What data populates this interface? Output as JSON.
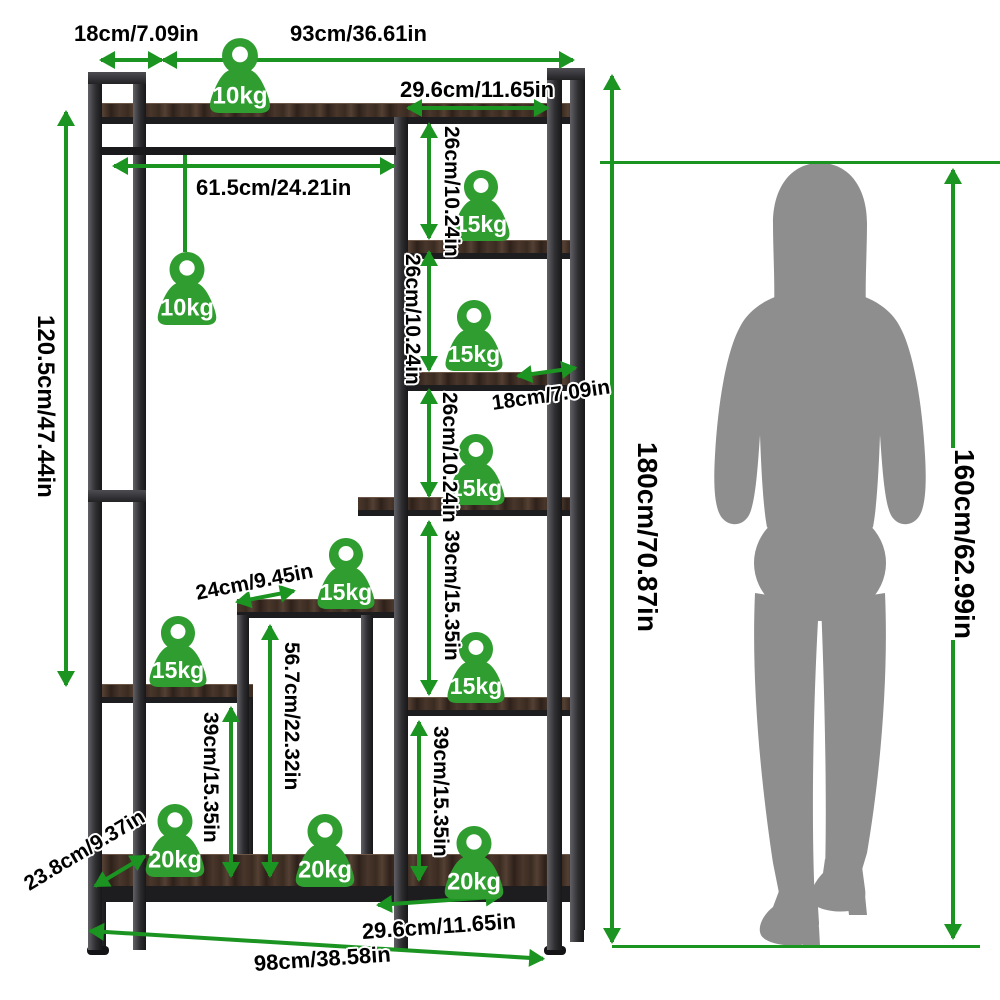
{
  "diagram": {
    "weights": {
      "top_shelf": "10kg",
      "hanging_rod": "10kg",
      "tower_shelf_1": "15kg",
      "tower_shelf_2": "15kg",
      "tower_shelf_3": "15kg",
      "step_shelf": "15kg",
      "left_shelf": "15kg",
      "tower_shelf_4": "15kg",
      "base_left": "20kg",
      "base_middle": "20kg",
      "base_right": "20kg"
    },
    "dimensions": {
      "top_depth": "18cm/7.09in",
      "top_width": "93cm/36.61in",
      "tower_width": "29.6cm/11.65in",
      "rod_length": "61.5cm/24.21in",
      "hanging_height": "120.5cm/47.44in",
      "tower_gap_1": "26cm/10.24in",
      "tower_gap_2": "26cm/10.24in",
      "tower_gap_3": "26cm/10.24in",
      "shelf_depth": "18cm/7.09in",
      "tower_gap_mid": "39cm/15.35in",
      "step_depth": "24cm/9.45in",
      "step_height": "56.7cm/22.32in",
      "left_shelf_height": "39cm/15.35in",
      "tower_gap_bottom": "39cm/15.35in",
      "base_depth": "23.8cm/9.37in",
      "base_inner_width": "29.6cm/11.65in",
      "total_width": "98cm/38.58in",
      "total_height": "180cm/70.87in",
      "person_height": "160cm/62.99in"
    },
    "colors": {
      "dimension_green": "#1c9421",
      "weight_green": "#2f9d2f",
      "silhouette_gray": "#8e8e8e",
      "metal_dark": "#2e2e31",
      "wood_brown": "#40302a"
    }
  }
}
